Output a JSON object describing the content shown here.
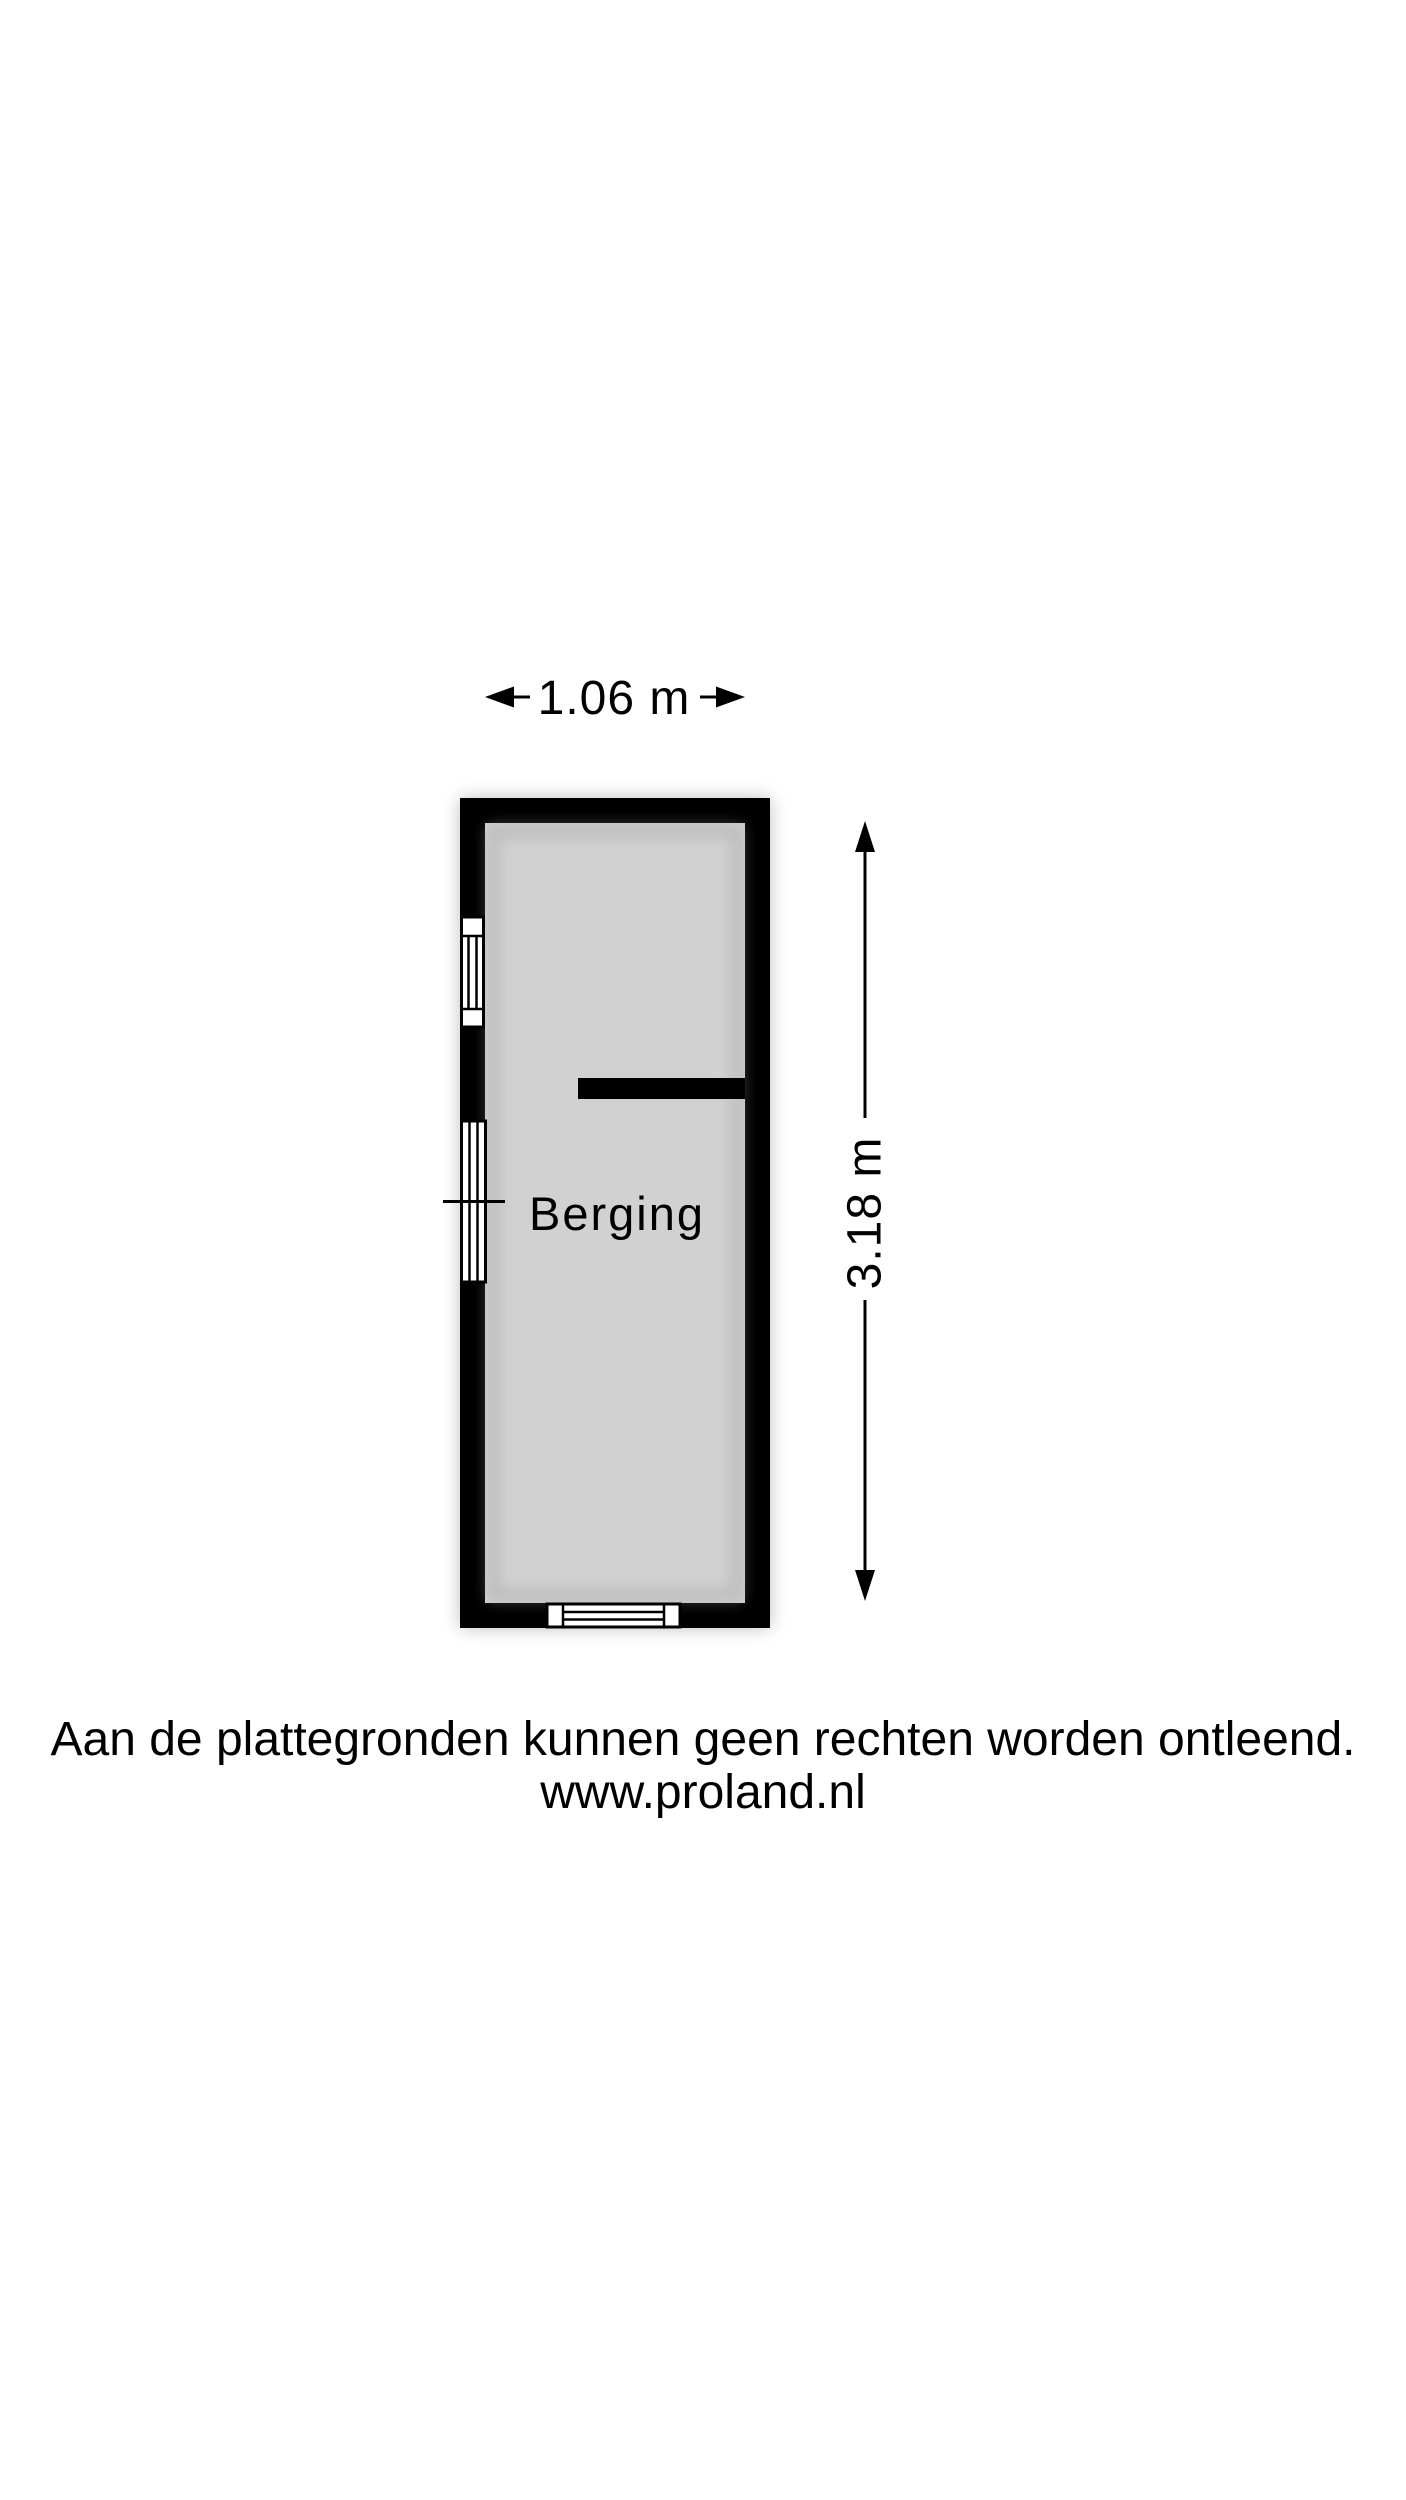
{
  "floorplan": {
    "room": {
      "label": "Berging"
    },
    "dimensions": {
      "width_label": "1.06 m",
      "height_label": "3.18 m"
    },
    "colors": {
      "wall": "#000000",
      "floor": "#d1d1d1",
      "opening_fill": "#ffffff",
      "background": "#ffffff"
    }
  },
  "footer": {
    "disclaimer": "Aan de plattegronden kunnen geen rechten worden ontleend.",
    "website": "www.proland.nl"
  }
}
